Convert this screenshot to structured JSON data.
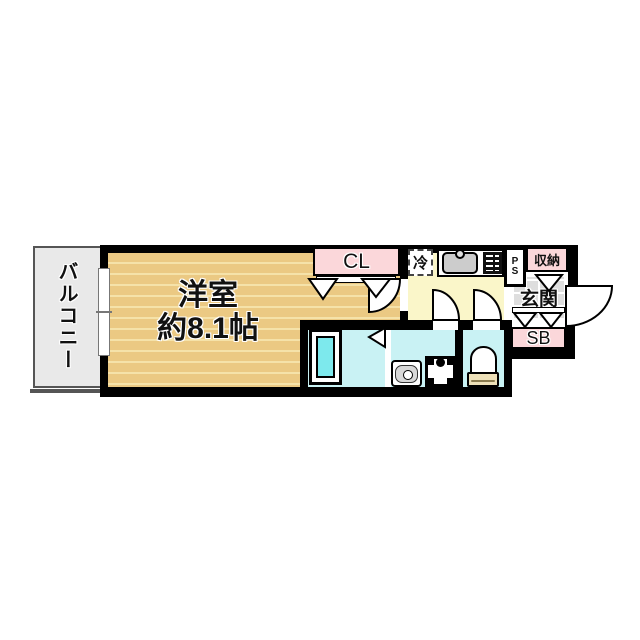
{
  "plan": {
    "balcony_label": "バルコニー",
    "main_room_name": "洋室",
    "main_room_size": "約8.1帖",
    "closet_label": "CL",
    "fridge_label": "冷",
    "pipe_space_p": "P",
    "pipe_space_s": "S",
    "storage_label": "収納",
    "entrance_label": "玄関",
    "shoebox_label": "SB"
  },
  "colors": {
    "wood_floor": "#ebc983",
    "wood_stripe": "#f5e2a9",
    "closet_pink": "#fbd7da",
    "kitchen_yellow": "#faf6c9",
    "wet_room_cyan": "#c9f2f4",
    "bathtub_cyan": "#7de9ed",
    "balcony_gray": "#e9e9e9",
    "entrance_tile_gray": "#dedede",
    "wall_black": "#000000"
  },
  "icons": {
    "kitchen_sink": "kitchen-sink-icon",
    "stove": "stove-icon",
    "bathtub": "bathtub-icon",
    "washbasin": "washbasin-icon",
    "washing_machine": "washing-machine-icon",
    "toilet": "toilet-icon",
    "doors": [
      "room-door-arc",
      "washroom-door-arc",
      "toilet-door-arc",
      "entry-door-arc"
    ]
  }
}
